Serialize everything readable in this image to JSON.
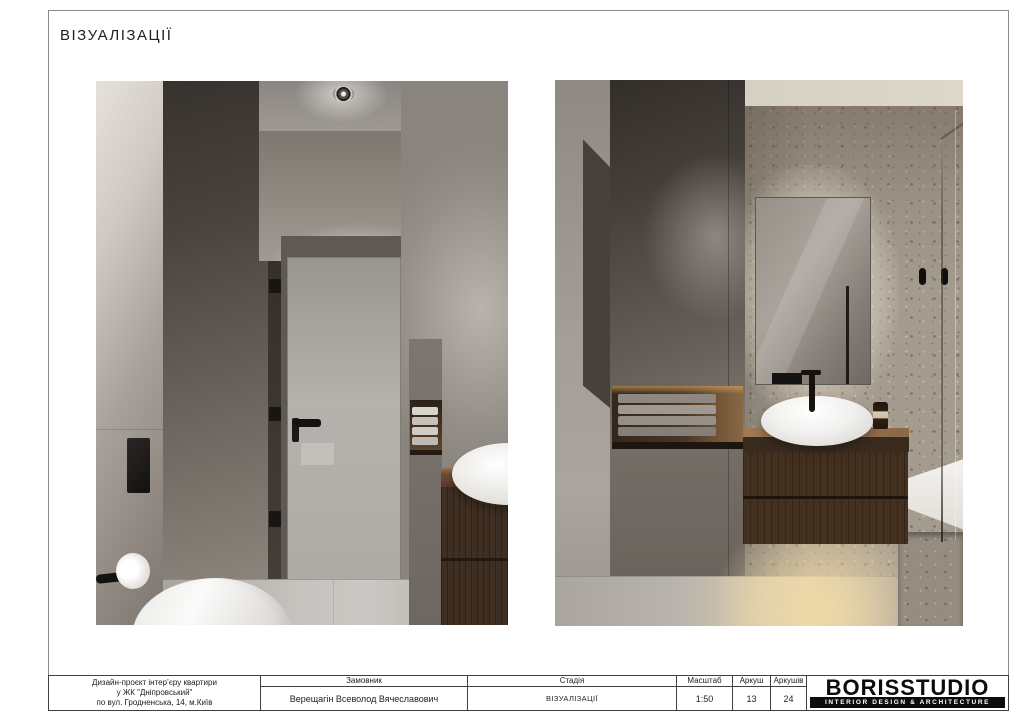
{
  "sheet": {
    "title": "ВІЗУАЛІЗАЦІЇ"
  },
  "title_block": {
    "project": {
      "line1": "Дизайн-проєкт інтер’єру квартири",
      "line2": "у ЖК \"Дніпровський\"",
      "line3": "по вул. Гродненська, 14, м.Київ"
    },
    "client": {
      "label": "Замовник",
      "value": "Верещагін Всеволод Вячеславович"
    },
    "stage": {
      "label": "Стадія",
      "value": "ВІЗУАЛІЗАЦІЇ"
    },
    "scale": {
      "label": "Масштаб",
      "value": "1:50"
    },
    "sheet_no": {
      "label": "Аркуш",
      "value": "13"
    },
    "sheet_total": {
      "label": "Аркушів",
      "value": "24"
    },
    "logo": {
      "name": "BORISSTUDIO",
      "tagline": "INTERIOR DESIGN & ARCHITECTURE"
    }
  },
  "colors": {
    "paper": "#ffffff",
    "frame_line": "#8a8a8a",
    "table_line": "#3f3f3f",
    "logo_black": "#0c0c0c"
  }
}
